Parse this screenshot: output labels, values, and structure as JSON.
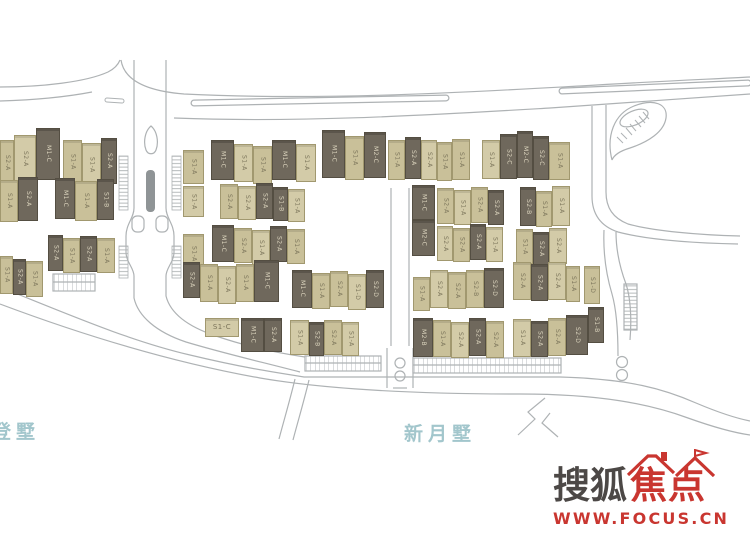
{
  "site_plan": {
    "colors": {
      "dark_building": "#6f685c",
      "dark_border": "#544e42",
      "dark_text": "#ddd6bf",
      "light_building": "#c9c099",
      "light_building_alt": "#d3cba8",
      "light_border": "#a1986f",
      "light_text": "#7b745a",
      "road_line": "#aeb2b4",
      "median_fill": "#8f9496",
      "area_label": "#a2c6cc"
    },
    "area_labels": [
      {
        "text": "登墅",
        "x": -8,
        "y": 417
      },
      {
        "text": "新月墅",
        "x": 404,
        "y": 419
      }
    ],
    "buildings": [
      {
        "x": 0,
        "y": 140,
        "w": 14,
        "h": 46,
        "t": "k",
        "l": "S2-A"
      },
      {
        "x": 14,
        "y": 135,
        "w": 22,
        "h": 48,
        "t": "k",
        "l": "S2-A"
      },
      {
        "x": 36,
        "y": 128,
        "w": 24,
        "h": 52,
        "t": "d",
        "l": "M1-C"
      },
      {
        "x": 63,
        "y": 140,
        "w": 19,
        "h": 44,
        "t": "k",
        "l": "S1-A"
      },
      {
        "x": 82,
        "y": 143,
        "w": 19,
        "h": 44,
        "t": "k",
        "l": "S1-A"
      },
      {
        "x": 101,
        "y": 138,
        "w": 16,
        "h": 46,
        "t": "d",
        "l": "S2-A"
      },
      {
        "x": 0,
        "y": 180,
        "w": 18,
        "h": 42,
        "t": "k",
        "l": "S1-A"
      },
      {
        "x": 18,
        "y": 177,
        "w": 20,
        "h": 44,
        "t": "d",
        "l": "S2-A"
      },
      {
        "x": 55,
        "y": 178,
        "w": 20,
        "h": 41,
        "t": "d",
        "l": "M1-C"
      },
      {
        "x": 75,
        "y": 181,
        "w": 22,
        "h": 40,
        "t": "k",
        "l": "S1-A"
      },
      {
        "x": 97,
        "y": 179,
        "w": 17,
        "h": 41,
        "t": "d",
        "l": "S1-B"
      },
      {
        "x": 48,
        "y": 235,
        "w": 15,
        "h": 36,
        "t": "d",
        "l": "S2-A"
      },
      {
        "x": 63,
        "y": 238,
        "w": 17,
        "h": 35,
        "t": "k",
        "l": "S1-A"
      },
      {
        "x": 80,
        "y": 236,
        "w": 17,
        "h": 36,
        "t": "d",
        "l": "S2-A"
      },
      {
        "x": 97,
        "y": 238,
        "w": 18,
        "h": 35,
        "t": "k",
        "l": "S1-A"
      },
      {
        "x": 0,
        "y": 256,
        "w": 13,
        "h": 38,
        "t": "k",
        "l": "S1-A"
      },
      {
        "x": 13,
        "y": 259,
        "w": 13,
        "h": 36,
        "t": "d",
        "l": "S2-A"
      },
      {
        "x": 26,
        "y": 261,
        "w": 17,
        "h": 36,
        "t": "k",
        "l": "S1-A"
      },
      {
        "x": 183,
        "y": 150,
        "w": 21,
        "h": 34,
        "t": "k",
        "l": "S1-A"
      },
      {
        "x": 183,
        "y": 186,
        "w": 21,
        "h": 31,
        "t": "k",
        "l": "S1-A"
      },
      {
        "x": 183,
        "y": 234,
        "w": 21,
        "h": 40,
        "t": "k",
        "l": "S1-A"
      },
      {
        "x": 211,
        "y": 140,
        "w": 23,
        "h": 40,
        "t": "d",
        "l": "M1-C"
      },
      {
        "x": 234,
        "y": 144,
        "w": 19,
        "h": 38,
        "t": "k",
        "l": "S1-A"
      },
      {
        "x": 253,
        "y": 146,
        "w": 19,
        "h": 38,
        "t": "k",
        "l": "S1-A"
      },
      {
        "x": 272,
        "y": 140,
        "w": 24,
        "h": 40,
        "t": "d",
        "l": "M1-C"
      },
      {
        "x": 296,
        "y": 144,
        "w": 20,
        "h": 38,
        "t": "k",
        "l": "S1-A"
      },
      {
        "x": 322,
        "y": 130,
        "w": 23,
        "h": 48,
        "t": "d",
        "l": "M1-C"
      },
      {
        "x": 345,
        "y": 136,
        "w": 19,
        "h": 44,
        "t": "k",
        "l": "S1-A"
      },
      {
        "x": 364,
        "y": 132,
        "w": 22,
        "h": 46,
        "t": "d",
        "l": "M2-C"
      },
      {
        "x": 388,
        "y": 140,
        "w": 17,
        "h": 40,
        "t": "k",
        "l": "S1-A"
      },
      {
        "x": 405,
        "y": 137,
        "w": 16,
        "h": 42,
        "t": "d",
        "l": "S2-A"
      },
      {
        "x": 421,
        "y": 140,
        "w": 16,
        "h": 40,
        "t": "k",
        "l": "S2-A"
      },
      {
        "x": 437,
        "y": 142,
        "w": 15,
        "h": 39,
        "t": "k",
        "l": "S1-A"
      },
      {
        "x": 452,
        "y": 139,
        "w": 18,
        "h": 41,
        "t": "k",
        "l": "S1-A"
      },
      {
        "x": 482,
        "y": 140,
        "w": 18,
        "h": 39,
        "t": "k",
        "l": "S1-A"
      },
      {
        "x": 500,
        "y": 134,
        "w": 17,
        "h": 45,
        "t": "d",
        "l": "S2-C"
      },
      {
        "x": 517,
        "y": 131,
        "w": 16,
        "h": 47,
        "t": "d",
        "l": "M2-C"
      },
      {
        "x": 533,
        "y": 136,
        "w": 16,
        "h": 44,
        "t": "d",
        "l": "S2-C"
      },
      {
        "x": 549,
        "y": 142,
        "w": 21,
        "h": 38,
        "t": "k",
        "l": "S1-A"
      },
      {
        "x": 220,
        "y": 184,
        "w": 18,
        "h": 35,
        "t": "k",
        "l": "S2-A"
      },
      {
        "x": 238,
        "y": 186,
        "w": 18,
        "h": 34,
        "t": "k",
        "l": "S2-A"
      },
      {
        "x": 256,
        "y": 183,
        "w": 17,
        "h": 36,
        "t": "d",
        "l": "S2-A"
      },
      {
        "x": 273,
        "y": 187,
        "w": 15,
        "h": 34,
        "t": "d",
        "l": "S1-B"
      },
      {
        "x": 288,
        "y": 189,
        "w": 17,
        "h": 33,
        "t": "k",
        "l": "S1-A"
      },
      {
        "x": 212,
        "y": 225,
        "w": 22,
        "h": 37,
        "t": "d",
        "l": "M1-C"
      },
      {
        "x": 234,
        "y": 228,
        "w": 18,
        "h": 35,
        "t": "k",
        "l": "S2-A"
      },
      {
        "x": 252,
        "y": 230,
        "w": 18,
        "h": 35,
        "t": "k",
        "l": "S1-A"
      },
      {
        "x": 270,
        "y": 226,
        "w": 17,
        "h": 36,
        "t": "d",
        "l": "S2-A"
      },
      {
        "x": 287,
        "y": 229,
        "w": 18,
        "h": 35,
        "t": "k",
        "l": "S1-A"
      },
      {
        "x": 412,
        "y": 185,
        "w": 23,
        "h": 35,
        "t": "d",
        "l": "M1-C"
      },
      {
        "x": 412,
        "y": 220,
        "w": 23,
        "h": 36,
        "t": "d",
        "l": "M2-C"
      },
      {
        "x": 437,
        "y": 188,
        "w": 17,
        "h": 36,
        "t": "k",
        "l": "S2-A"
      },
      {
        "x": 454,
        "y": 190,
        "w": 17,
        "h": 35,
        "t": "k",
        "l": "S1-A"
      },
      {
        "x": 471,
        "y": 187,
        "w": 17,
        "h": 36,
        "t": "k",
        "l": "S2-A"
      },
      {
        "x": 488,
        "y": 190,
        "w": 16,
        "h": 35,
        "t": "d",
        "l": "S2-A"
      },
      {
        "x": 437,
        "y": 226,
        "w": 16,
        "h": 35,
        "t": "k",
        "l": "S2-A"
      },
      {
        "x": 453,
        "y": 228,
        "w": 17,
        "h": 34,
        "t": "k",
        "l": "S2-A"
      },
      {
        "x": 470,
        "y": 224,
        "w": 16,
        "h": 36,
        "t": "d",
        "l": "S2-A"
      },
      {
        "x": 486,
        "y": 227,
        "w": 17,
        "h": 35,
        "t": "k",
        "l": "S1-A"
      },
      {
        "x": 520,
        "y": 187,
        "w": 16,
        "h": 39,
        "t": "d",
        "l": "S2-B"
      },
      {
        "x": 536,
        "y": 191,
        "w": 16,
        "h": 36,
        "t": "k",
        "l": "S1-A"
      },
      {
        "x": 552,
        "y": 186,
        "w": 18,
        "h": 40,
        "t": "k",
        "l": "S1-A"
      },
      {
        "x": 516,
        "y": 229,
        "w": 17,
        "h": 35,
        "t": "k",
        "l": "S1-A"
      },
      {
        "x": 533,
        "y": 232,
        "w": 16,
        "h": 34,
        "t": "d",
        "l": "S2-A"
      },
      {
        "x": 549,
        "y": 228,
        "w": 18,
        "h": 36,
        "t": "k",
        "l": "S2-A"
      },
      {
        "x": 183,
        "y": 262,
        "w": 17,
        "h": 36,
        "t": "d",
        "l": "S2-A"
      },
      {
        "x": 200,
        "y": 264,
        "w": 18,
        "h": 38,
        "t": "k",
        "l": "S1-A"
      },
      {
        "x": 218,
        "y": 266,
        "w": 18,
        "h": 38,
        "t": "k",
        "l": "S2-A"
      },
      {
        "x": 236,
        "y": 264,
        "w": 18,
        "h": 38,
        "t": "k",
        "l": "S1-A"
      },
      {
        "x": 254,
        "y": 260,
        "w": 25,
        "h": 42,
        "t": "d",
        "l": "M1-C"
      },
      {
        "x": 292,
        "y": 270,
        "w": 20,
        "h": 38,
        "t": "d",
        "l": "M1-C"
      },
      {
        "x": 312,
        "y": 273,
        "w": 18,
        "h": 36,
        "t": "k",
        "l": "S1-A"
      },
      {
        "x": 330,
        "y": 271,
        "w": 18,
        "h": 36,
        "t": "k",
        "l": "S2-A"
      },
      {
        "x": 348,
        "y": 274,
        "w": 18,
        "h": 36,
        "t": "k",
        "l": "S1-D"
      },
      {
        "x": 366,
        "y": 270,
        "w": 18,
        "h": 38,
        "t": "d",
        "l": "S2-D"
      },
      {
        "x": 413,
        "y": 277,
        "w": 17,
        "h": 34,
        "t": "k",
        "l": "S1-A"
      },
      {
        "x": 430,
        "y": 270,
        "w": 18,
        "h": 38,
        "t": "k",
        "l": "S2-A"
      },
      {
        "x": 448,
        "y": 272,
        "w": 18,
        "h": 37,
        "t": "k",
        "l": "S2-A"
      },
      {
        "x": 466,
        "y": 270,
        "w": 18,
        "h": 38,
        "t": "k",
        "l": "S2-B"
      },
      {
        "x": 484,
        "y": 268,
        "w": 20,
        "h": 40,
        "t": "d",
        "l": "S2-D"
      },
      {
        "x": 513,
        "y": 262,
        "w": 18,
        "h": 38,
        "t": "k",
        "l": "S2-A"
      },
      {
        "x": 531,
        "y": 264,
        "w": 17,
        "h": 37,
        "t": "d",
        "l": "S2-A"
      },
      {
        "x": 548,
        "y": 262,
        "w": 18,
        "h": 38,
        "t": "k",
        "l": "S2-A"
      },
      {
        "x": 566,
        "y": 266,
        "w": 14,
        "h": 36,
        "t": "k",
        "l": "S1-A"
      },
      {
        "x": 584,
        "y": 266,
        "w": 16,
        "h": 38,
        "t": "k",
        "l": "S1-D"
      },
      {
        "x": 205,
        "y": 318,
        "w": 34,
        "h": 19,
        "t": "k",
        "l": "S1-C",
        "o": "h"
      },
      {
        "x": 241,
        "y": 318,
        "w": 23,
        "h": 34,
        "t": "d",
        "l": "M1-C"
      },
      {
        "x": 264,
        "y": 318,
        "w": 18,
        "h": 34,
        "t": "d",
        "l": "S2-A"
      },
      {
        "x": 290,
        "y": 320,
        "w": 19,
        "h": 35,
        "t": "k",
        "l": "S1-A"
      },
      {
        "x": 309,
        "y": 322,
        "w": 15,
        "h": 34,
        "t": "d",
        "l": "S2-B"
      },
      {
        "x": 324,
        "y": 320,
        "w": 18,
        "h": 35,
        "t": "k",
        "l": "S2-A"
      },
      {
        "x": 342,
        "y": 322,
        "w": 17,
        "h": 34,
        "t": "k",
        "l": "S1-A"
      },
      {
        "x": 413,
        "y": 318,
        "w": 20,
        "h": 39,
        "t": "d",
        "l": "M2-B"
      },
      {
        "x": 433,
        "y": 320,
        "w": 18,
        "h": 37,
        "t": "k",
        "l": "S1-A"
      },
      {
        "x": 451,
        "y": 322,
        "w": 18,
        "h": 36,
        "t": "k",
        "l": "S2-A"
      },
      {
        "x": 469,
        "y": 318,
        "w": 17,
        "h": 38,
        "t": "d",
        "l": "S2-A"
      },
      {
        "x": 486,
        "y": 321,
        "w": 18,
        "h": 37,
        "t": "k",
        "l": "S2-A"
      },
      {
        "x": 513,
        "y": 319,
        "w": 18,
        "h": 38,
        "t": "k",
        "l": "S1-A"
      },
      {
        "x": 531,
        "y": 321,
        "w": 17,
        "h": 36,
        "t": "d",
        "l": "S2-A"
      },
      {
        "x": 548,
        "y": 318,
        "w": 18,
        "h": 38,
        "t": "k",
        "l": "S2-A"
      },
      {
        "x": 566,
        "y": 315,
        "w": 22,
        "h": 40,
        "t": "d",
        "l": "S2-D"
      },
      {
        "x": 588,
        "y": 307,
        "w": 16,
        "h": 36,
        "t": "d",
        "l": "S1-B"
      }
    ]
  },
  "watermark": {
    "brand_left": "搜狐",
    "brand_right": "焦点",
    "url": "WWW.FOCUS.CN",
    "brand_dark_color": "#4c4846",
    "brand_red_color": "#c93630"
  }
}
